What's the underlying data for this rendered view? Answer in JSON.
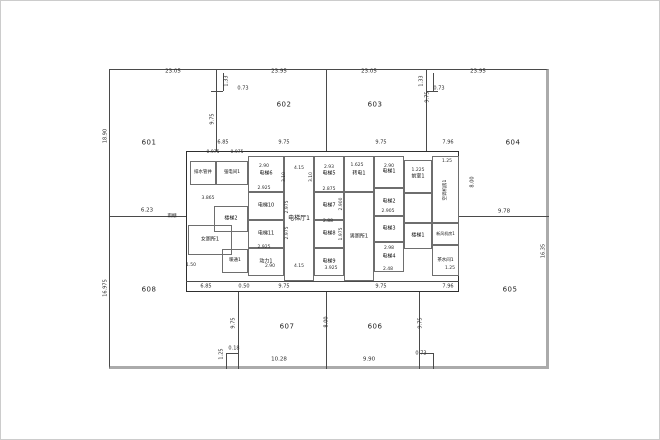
{
  "drawing": {
    "title": "floor-plan",
    "background_color": "#ffffff",
    "wall_color": "#4a4a4a",
    "thick_wall_color": "#ababab",
    "text_color": "#1a1a1a",
    "zones": [
      {
        "label": "601",
        "x": 148,
        "y": 142
      },
      {
        "label": "602",
        "x": 283,
        "y": 104
      },
      {
        "label": "603",
        "x": 374,
        "y": 104
      },
      {
        "label": "604",
        "x": 512,
        "y": 142
      },
      {
        "label": "605",
        "x": 509,
        "y": 289
      },
      {
        "label": "606",
        "x": 374,
        "y": 326
      },
      {
        "label": "607",
        "x": 286,
        "y": 326
      },
      {
        "label": "608",
        "x": 148,
        "y": 289
      }
    ],
    "rooms": [
      {
        "label": "排水管井",
        "x": 189,
        "y": 160,
        "w": 26,
        "h": 24,
        "fs": 4.5,
        "vert": false
      },
      {
        "label": "强电间1",
        "x": 215,
        "y": 160,
        "w": 32,
        "h": 24,
        "fs": 4.5,
        "vert": false
      },
      {
        "label": "楼梯2",
        "x": 213,
        "y": 205,
        "w": 34,
        "h": 26,
        "fs": 5,
        "vert": false
      },
      {
        "label": "女厕所1",
        "x": 187,
        "y": 224,
        "w": 44,
        "h": 30,
        "fs": 5,
        "vert": false
      },
      {
        "label": "暖通1",
        "x": 221,
        "y": 248,
        "w": 26,
        "h": 24,
        "fs": 4.5,
        "vert": false
      },
      {
        "label": "电梯6",
        "x": 247,
        "y": 155,
        "w": 36,
        "h": 36,
        "fs": 5,
        "vert": false
      },
      {
        "label": "电梯10",
        "x": 247,
        "y": 191,
        "w": 36,
        "h": 28,
        "fs": 5,
        "vert": false
      },
      {
        "label": "电梯11",
        "x": 247,
        "y": 219,
        "w": 36,
        "h": 28,
        "fs": 5,
        "vert": false
      },
      {
        "label": "动力1",
        "x": 247,
        "y": 247,
        "w": 36,
        "h": 28,
        "fs": 5,
        "vert": false
      },
      {
        "label": "电梯厅1",
        "x": 283,
        "y": 155,
        "w": 30,
        "h": 125,
        "fs": 6,
        "vert": false
      },
      {
        "label": "电梯5",
        "x": 313,
        "y": 155,
        "w": 30,
        "h": 36,
        "fs": 5,
        "vert": false
      },
      {
        "label": "电梯7",
        "x": 313,
        "y": 191,
        "w": 30,
        "h": 28,
        "fs": 5,
        "vert": false
      },
      {
        "label": "电梯8",
        "x": 313,
        "y": 219,
        "w": 30,
        "h": 28,
        "fs": 5,
        "vert": false
      },
      {
        "label": "电梯9",
        "x": 313,
        "y": 247,
        "w": 30,
        "h": 28,
        "fs": 5,
        "vert": false
      },
      {
        "label": "转电1",
        "x": 343,
        "y": 155,
        "w": 30,
        "h": 36,
        "fs": 5,
        "vert": false
      },
      {
        "label": "男厕所1",
        "x": 343,
        "y": 191,
        "w": 30,
        "h": 89,
        "fs": 5,
        "vert": false
      },
      {
        "label": "电梯1",
        "x": 373,
        "y": 155,
        "w": 30,
        "h": 32,
        "fs": 5,
        "vert": false
      },
      {
        "label": "电梯2",
        "x": 373,
        "y": 187,
        "w": 30,
        "h": 28,
        "fs": 5,
        "vert": false
      },
      {
        "label": "电梯3",
        "x": 373,
        "y": 215,
        "w": 30,
        "h": 26,
        "fs": 5,
        "vert": false
      },
      {
        "label": "电梯4",
        "x": 373,
        "y": 241,
        "w": 30,
        "h": 30,
        "fs": 5,
        "vert": false
      },
      {
        "label": "前室1",
        "x": 403,
        "y": 159,
        "w": 28,
        "h": 33,
        "fs": 5,
        "vert": false
      },
      {
        "label": "",
        "x": 403,
        "y": 192,
        "w": 28,
        "h": 30,
        "fs": 5,
        "vert": false
      },
      {
        "label": "楼梯1",
        "x": 403,
        "y": 222,
        "w": 28,
        "h": 26,
        "fs": 5,
        "vert": false
      },
      {
        "label": "新风机房1",
        "x": 431,
        "y": 222,
        "w": 27,
        "h": 22,
        "fs": 4,
        "vert": false
      },
      {
        "label": "茶水间1",
        "x": 431,
        "y": 244,
        "w": 27,
        "h": 31,
        "fs": 4.5,
        "vert": false
      },
      {
        "label": "空调机房1",
        "x": 431,
        "y": 155,
        "w": 27,
        "h": 67,
        "fs": 4.5,
        "vert": true
      }
    ],
    "dims": [
      {
        "text": "23.05",
        "x": 172,
        "y": 71,
        "rot": false,
        "fs": 5.5
      },
      {
        "text": "23.95",
        "x": 278,
        "y": 71,
        "rot": false,
        "fs": 5.5
      },
      {
        "text": "23.05",
        "x": 368,
        "y": 71,
        "rot": false,
        "fs": 5.5
      },
      {
        "text": "23.95",
        "x": 477,
        "y": 71,
        "rot": false,
        "fs": 5.5
      },
      {
        "text": "1.33",
        "x": 226,
        "y": 80,
        "rot": true,
        "fs": 5
      },
      {
        "text": "0.73",
        "x": 242,
        "y": 88,
        "rot": false,
        "fs": 5
      },
      {
        "text": "1.33",
        "x": 421,
        "y": 80,
        "rot": true,
        "fs": 5
      },
      {
        "text": "0.73",
        "x": 438,
        "y": 88,
        "rot": false,
        "fs": 5
      },
      {
        "text": "18.90",
        "x": 105,
        "y": 135,
        "rot": true,
        "fs": 5
      },
      {
        "text": "16.975",
        "x": 105,
        "y": 287,
        "rot": true,
        "fs": 5
      },
      {
        "text": "16.35",
        "x": 543,
        "y": 250,
        "rot": true,
        "fs": 5
      },
      {
        "text": "6.23",
        "x": 146,
        "y": 210,
        "rot": false,
        "fs": 5.5
      },
      {
        "text": "9.78",
        "x": 503,
        "y": 211,
        "rot": false,
        "fs": 5.5
      },
      {
        "text": "10.28",
        "x": 278,
        "y": 359,
        "rot": false,
        "fs": 5.5
      },
      {
        "text": "9.90",
        "x": 368,
        "y": 359,
        "rot": false,
        "fs": 5.5
      },
      {
        "text": "0.73",
        "x": 420,
        "y": 353,
        "rot": false,
        "fs": 5
      },
      {
        "text": "0.18",
        "x": 233,
        "y": 348,
        "rot": false,
        "fs": 5
      },
      {
        "text": "1.25",
        "x": 221,
        "y": 353,
        "rot": true,
        "fs": 5
      },
      {
        "text": "9.75",
        "x": 212,
        "y": 118,
        "rot": true,
        "fs": 5
      },
      {
        "text": "9.75",
        "x": 427,
        "y": 96,
        "rot": true,
        "fs": 5
      },
      {
        "text": "9.75",
        "x": 233,
        "y": 322,
        "rot": true,
        "fs": 5
      },
      {
        "text": "9.75",
        "x": 420,
        "y": 322,
        "rot": true,
        "fs": 5
      },
      {
        "text": "8.00",
        "x": 326,
        "y": 321,
        "rot": true,
        "fs": 5
      },
      {
        "text": "8.00",
        "x": 472,
        "y": 181,
        "rot": true,
        "fs": 5
      },
      {
        "text": "6.85",
        "x": 222,
        "y": 142,
        "rot": false,
        "fs": 5
      },
      {
        "text": "9.75",
        "x": 283,
        "y": 142,
        "rot": false,
        "fs": 5
      },
      {
        "text": "9.75",
        "x": 380,
        "y": 142,
        "rot": false,
        "fs": 5
      },
      {
        "text": "7.96",
        "x": 447,
        "y": 142,
        "rot": false,
        "fs": 5
      },
      {
        "text": "6.85",
        "x": 205,
        "y": 286,
        "rot": false,
        "fs": 5
      },
      {
        "text": "0.50",
        "x": 243,
        "y": 286,
        "rot": false,
        "fs": 5
      },
      {
        "text": "9.75",
        "x": 283,
        "y": 286,
        "rot": false,
        "fs": 5
      },
      {
        "text": "9.75",
        "x": 380,
        "y": 286,
        "rot": false,
        "fs": 5
      },
      {
        "text": "7.96",
        "x": 447,
        "y": 286,
        "rot": false,
        "fs": 5
      },
      {
        "text": "0.975",
        "x": 212,
        "y": 152,
        "rot": false,
        "fs": 4.5
      },
      {
        "text": "0.975",
        "x": 236,
        "y": 152,
        "rot": false,
        "fs": 4.5
      },
      {
        "text": "2.90",
        "x": 263,
        "y": 166,
        "rot": false,
        "fs": 4.5
      },
      {
        "text": "2.925",
        "x": 263,
        "y": 188,
        "rot": false,
        "fs": 4.5
      },
      {
        "text": "3.865",
        "x": 207,
        "y": 198,
        "rot": false,
        "fs": 4.5
      },
      {
        "text": "1.50",
        "x": 190,
        "y": 265,
        "rot": false,
        "fs": 4.5
      },
      {
        "text": "2.925",
        "x": 263,
        "y": 247,
        "rot": false,
        "fs": 4.5
      },
      {
        "text": "2.90",
        "x": 269,
        "y": 266,
        "rot": false,
        "fs": 4.5
      },
      {
        "text": "4.15",
        "x": 298,
        "y": 168,
        "rot": false,
        "fs": 4.5
      },
      {
        "text": "4.15",
        "x": 298,
        "y": 266,
        "rot": false,
        "fs": 4.5
      },
      {
        "text": "2.93",
        "x": 328,
        "y": 167,
        "rot": false,
        "fs": 4.5
      },
      {
        "text": "2.875",
        "x": 328,
        "y": 189,
        "rot": false,
        "fs": 4.5
      },
      {
        "text": "2.88",
        "x": 327,
        "y": 221,
        "rot": false,
        "fs": 4.5
      },
      {
        "text": "3.925",
        "x": 330,
        "y": 268,
        "rot": false,
        "fs": 4.5
      },
      {
        "text": "1.625",
        "x": 356,
        "y": 165,
        "rot": false,
        "fs": 4.5
      },
      {
        "text": "2.90",
        "x": 388,
        "y": 166,
        "rot": false,
        "fs": 4.5
      },
      {
        "text": "2.905",
        "x": 387,
        "y": 211,
        "rot": false,
        "fs": 4.5
      },
      {
        "text": "2.98",
        "x": 388,
        "y": 248,
        "rot": false,
        "fs": 4.5
      },
      {
        "text": "2.48",
        "x": 387,
        "y": 269,
        "rot": false,
        "fs": 4.5
      },
      {
        "text": "1.225",
        "x": 417,
        "y": 170,
        "rot": false,
        "fs": 4.5
      },
      {
        "text": "1.25",
        "x": 446,
        "y": 161,
        "rot": false,
        "fs": 4.5
      },
      {
        "text": "1.25",
        "x": 449,
        "y": 268,
        "rot": false,
        "fs": 4.5
      },
      {
        "text": "3.10",
        "x": 284,
        "y": 176,
        "rot": true,
        "fs": 4.5
      },
      {
        "text": "3.10",
        "x": 311,
        "y": 176,
        "rot": true,
        "fs": 4.5
      },
      {
        "text": "2.975",
        "x": 287,
        "y": 206,
        "rot": true,
        "fs": 4.5
      },
      {
        "text": "2.975",
        "x": 287,
        "y": 232,
        "rot": true,
        "fs": 4.5
      },
      {
        "text": "2.900",
        "x": 341,
        "y": 203,
        "rot": true,
        "fs": 4.5
      },
      {
        "text": "1.975",
        "x": 341,
        "y": 233,
        "rot": true,
        "fs": 4.5
      }
    ],
    "annotations": [
      {
        "text": "雨棚",
        "x": 171,
        "y": 216
      }
    ]
  }
}
